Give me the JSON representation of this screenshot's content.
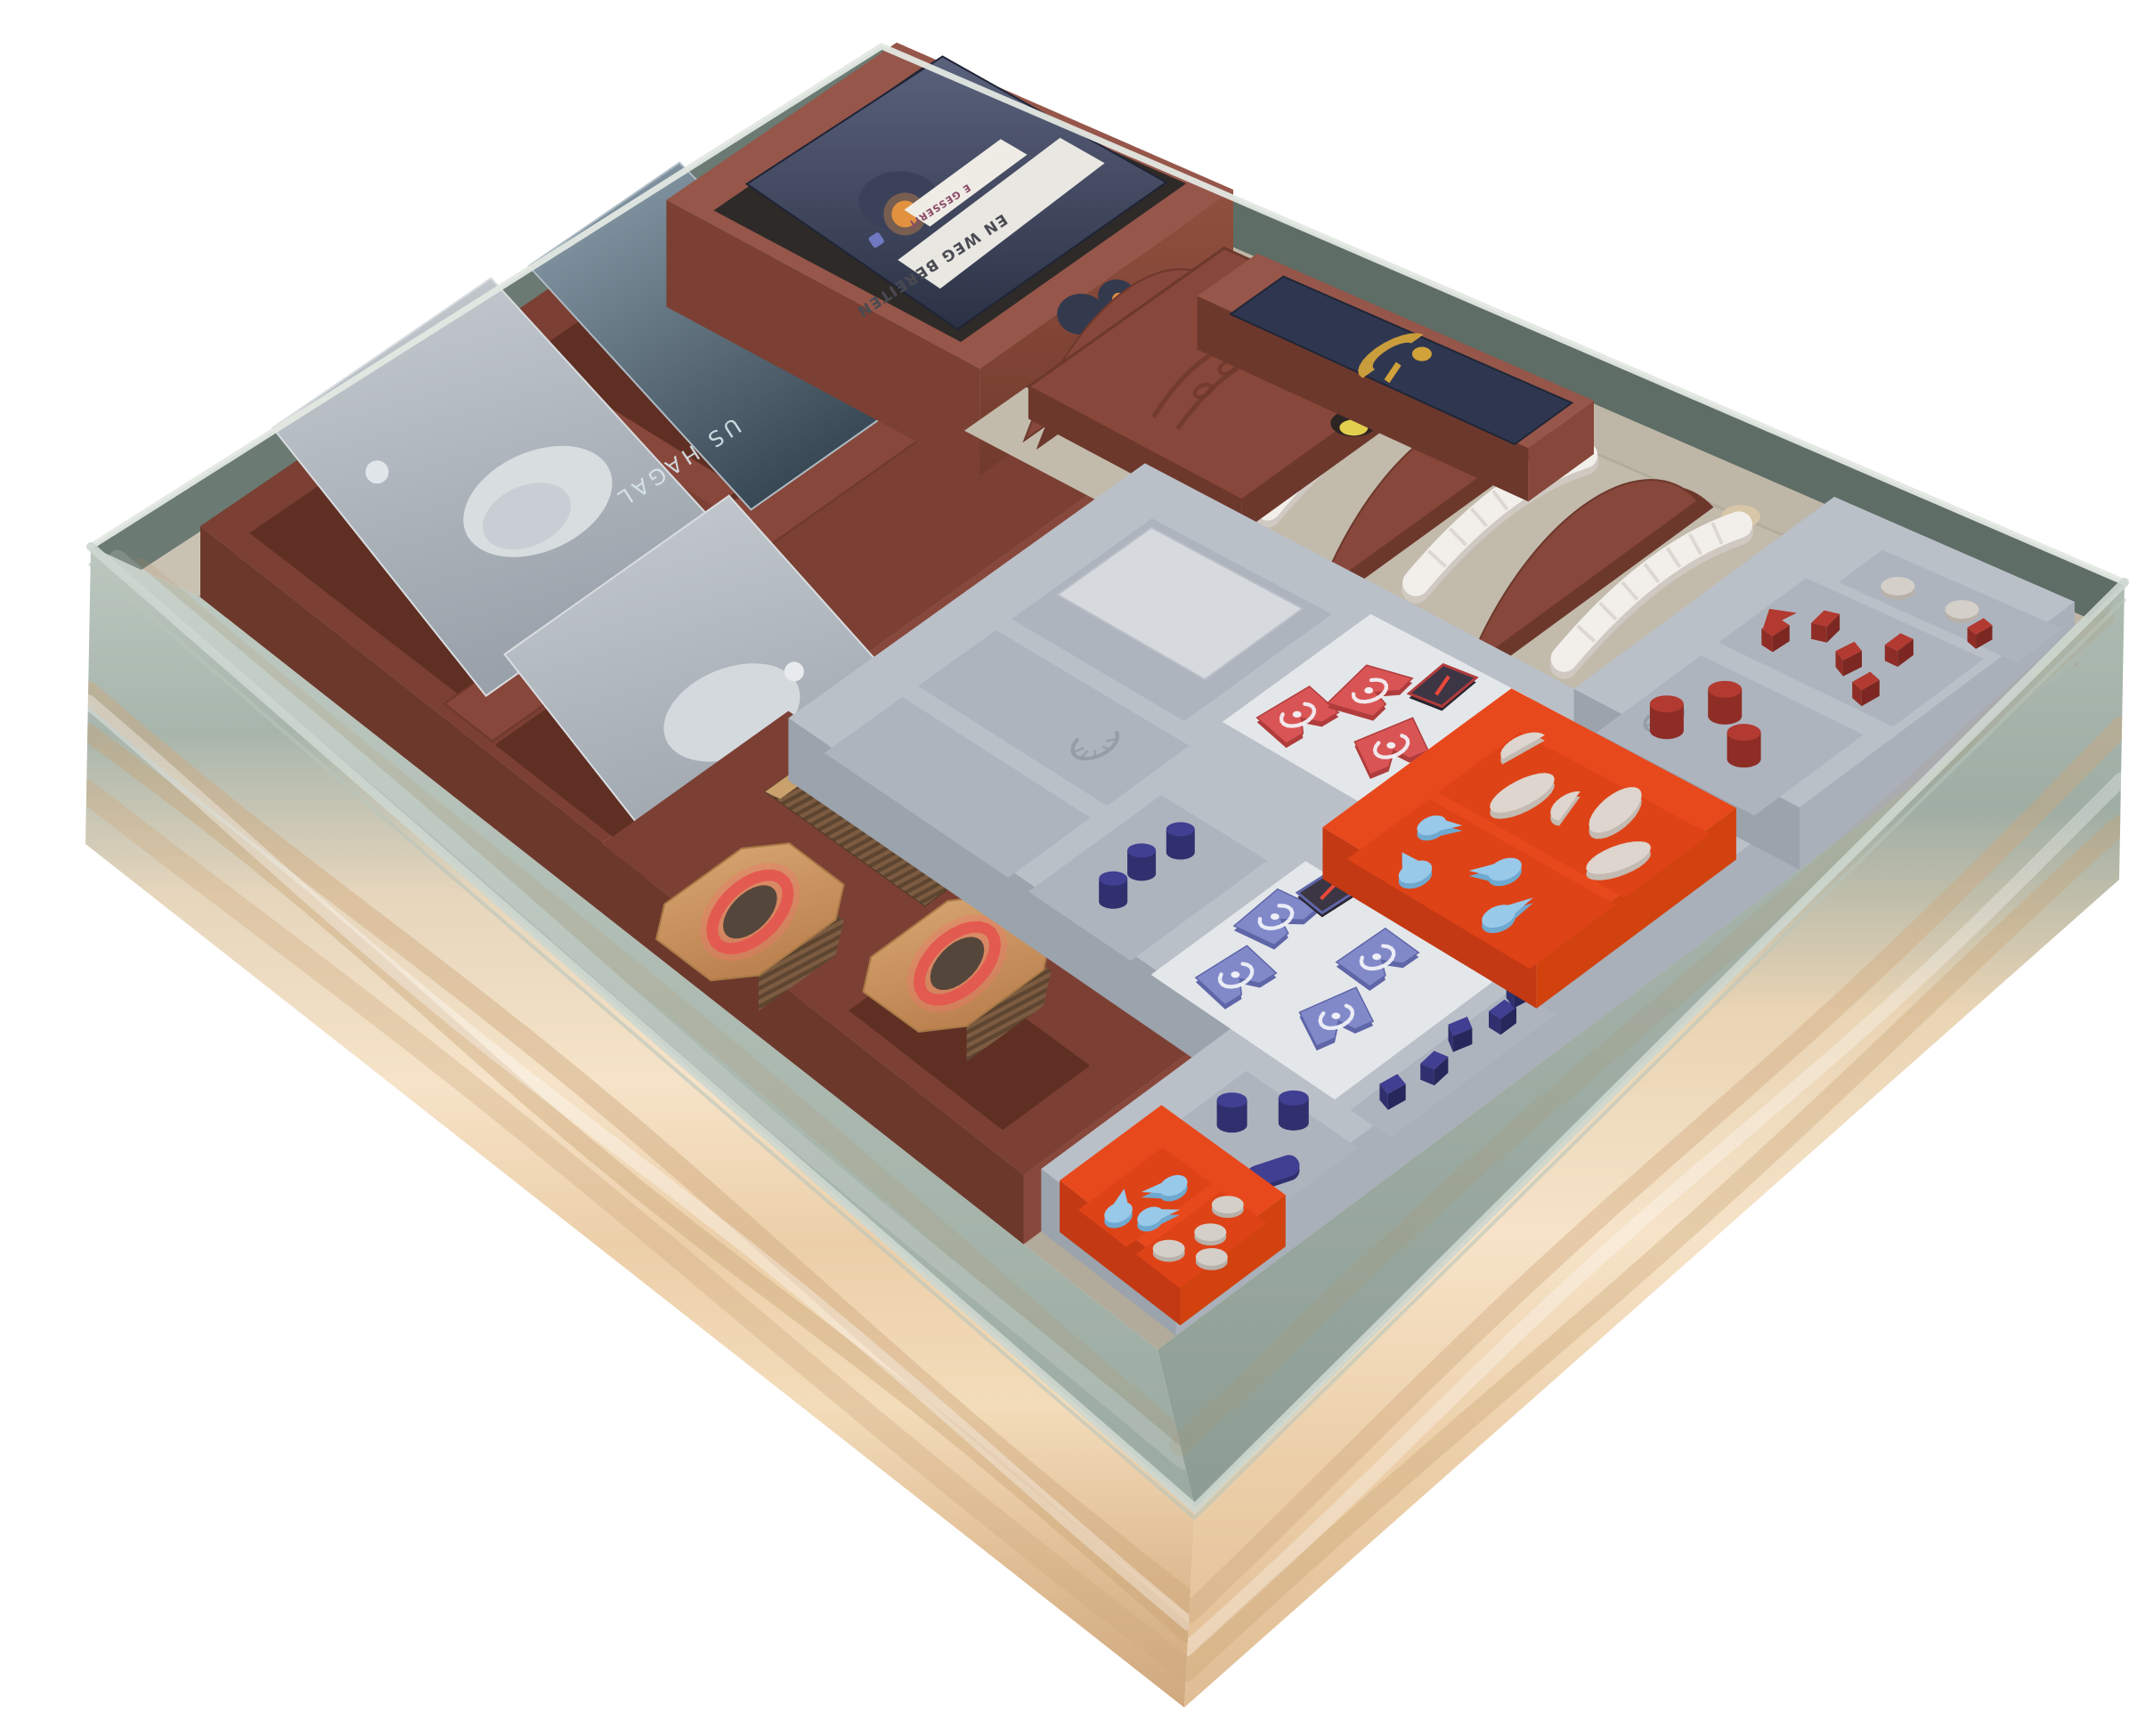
{
  "meta": {
    "subject": "Open square board game box with a 3D-printed organizer insert holding sleeved card decks, token trays, wooden tokens and textured sandworm figures",
    "background": "#ffffff"
  },
  "texts": {
    "deck_card_title": "EN WEG BEREITEN",
    "deck_card_subtitle": "E GESSERIT",
    "hagal_card_label": "US HAGAL"
  },
  "palette": {
    "bg": "#ffffff",
    "greenRim": "#a8b5ac",
    "greenWallBL": "#6b7a72",
    "greenWallBR": "#5e6d65",
    "frostTopL": "#bcc8bf",
    "frostBotL": "#98a89e",
    "frostTopR": "#aebbb2",
    "frostBotR": "#8a9a90",
    "cardboard": "#c9c2b3",
    "cardboardDark": "#beb6a7",
    "cardboardFloor": "#c2bbac",
    "floor": "#b2aa9b",
    "dune1": "#f6e3c8",
    "dune2": "#eccfa9",
    "dune3": "#e0bd94",
    "duneShadow": "#cfa87e",
    "brown": "#87473a",
    "brownDark": "#6d382c",
    "brownLight": "#96564a",
    "brownSide": "#7b4033",
    "slotDark": "#5f2f24",
    "gray": "#bac0c8",
    "grayDark": "#9ba3ad",
    "grayFront": "#a9b0ba",
    "grayFloor": "#adb4be",
    "whiteFloor": "#e4e7ea",
    "orange": "#e8491c",
    "orangeDark": "#c33913",
    "orangeFloor": "#de4317",
    "redFlag": "#d95555",
    "redFlagDark": "#b03c3c",
    "redWood": "#b23a31",
    "redWoodDark": "#8e2d26",
    "blueFlag": "#8289c9",
    "blueFlagDark": "#5f66a8",
    "navy": "#403f92",
    "navyDark": "#30306e",
    "lightBlue": "#99c9e9",
    "lightBlueDark": "#6fa9d0",
    "cream": "#ddd5ce",
    "creamDark": "#c3bab2",
    "disc": "#d5cfc9",
    "discDark": "#b8b1aa",
    "worm": "#f2efeb",
    "wormShade": "#cfc9c2",
    "ring": "#f4766b",
    "ringDark": "#e35a50",
    "tileBlob": "#55463c",
    "gold": "#d2a23a",
    "yellow": "#e3cf4e",
    "cardNavy": "#2f3750"
  },
  "components": {
    "box": {
      "label": "game box with sage green rim and dune artwork"
    },
    "card_trays": {
      "label": "brown 3D-printed card trays",
      "count": 4
    },
    "deck_box": {
      "label": "tall card deck box with scalloped cutout",
      "count": 1
    },
    "lid": {
      "label": "embossed brown lid with sandworm motif",
      "count": 1
    },
    "intrigue_tray": {
      "label": "brown tray with dark card, gold emblem",
      "count": 1
    },
    "sandworm_rack": {
      "label": "brown fin rack holding textured sandworms",
      "fins": 5,
      "worms": 4
    },
    "token_trays": {
      "label": "gray token trays with compartments",
      "count": 3
    },
    "bit_boxes": {
      "label": "orange removable bit boxes",
      "count": 2
    },
    "tokens": {
      "red_flag_tiles": 3,
      "red_combat_tile": 1,
      "blue_flag_tiles": 4,
      "blue_combat_tile": 1,
      "navy_cylinders": 6,
      "navy_cubes": 5,
      "red_cylinders": 3,
      "red_cubes": 6,
      "red_triangle": 1,
      "water_drop_tokens": 7,
      "cream_ovals": 3,
      "cream_half_discs": 2,
      "gray_discs": 6,
      "spice_tile_stacks": 2,
      "tan_tokens": 3,
      "yellow_token": 1
    },
    "cards": {
      "planet_art_cards": 2,
      "hagal_deck": 1,
      "german_deck_card": 1
    }
  }
}
